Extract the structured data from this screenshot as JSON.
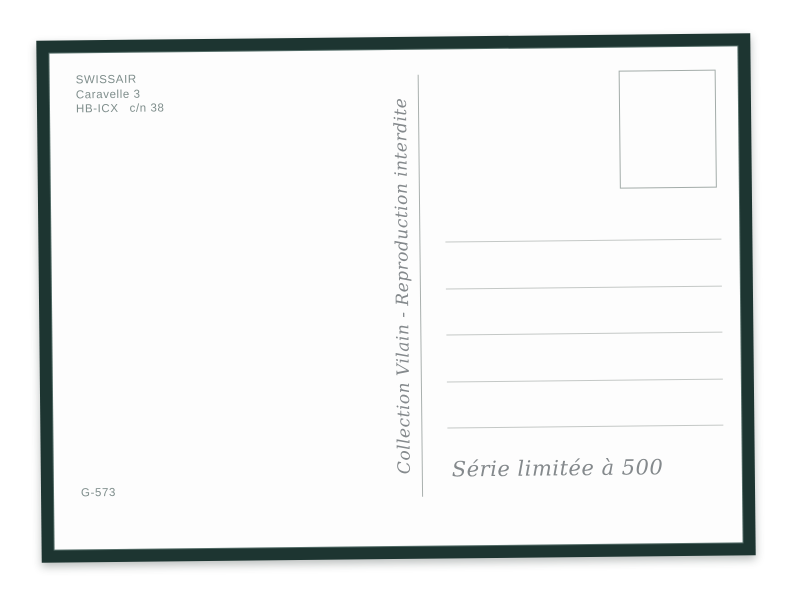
{
  "postcard": {
    "header": {
      "airline": "SWISSAIR",
      "aircraft_type": "Caravelle 3",
      "registration": "HB-ICX",
      "construction_number": "c/n 38"
    },
    "spine": {
      "credit": "Collection Vilain - Reproduction interdite"
    },
    "address_ruled_lines": 5,
    "footer": {
      "series_note": "Série limitée à 500",
      "catalog_number": "G-573"
    },
    "colors": {
      "frame": "#1d3531",
      "paper": "#fdfdfd",
      "ink": "#7f8e8c",
      "script_ink": "#84898c",
      "rule_line": "#c4c8c6",
      "stamp_border": "#a3aca9"
    }
  }
}
